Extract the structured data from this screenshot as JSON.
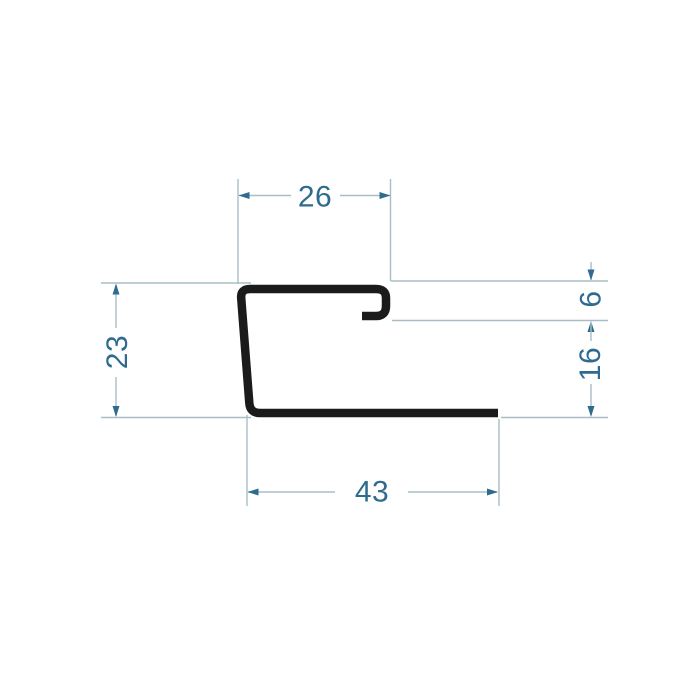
{
  "drawing": {
    "kind": "technical-profile-cross-section",
    "colors": {
      "background": "#ffffff",
      "profile": "#1b1b1b",
      "dimension_line": "#a9bdc7",
      "dimension_accent": "#2e6b8f"
    },
    "dimensions": {
      "top_width": "26",
      "left_height": "23",
      "hook_depth": "6",
      "right_lower_height": "16",
      "bottom_width": "43"
    }
  }
}
